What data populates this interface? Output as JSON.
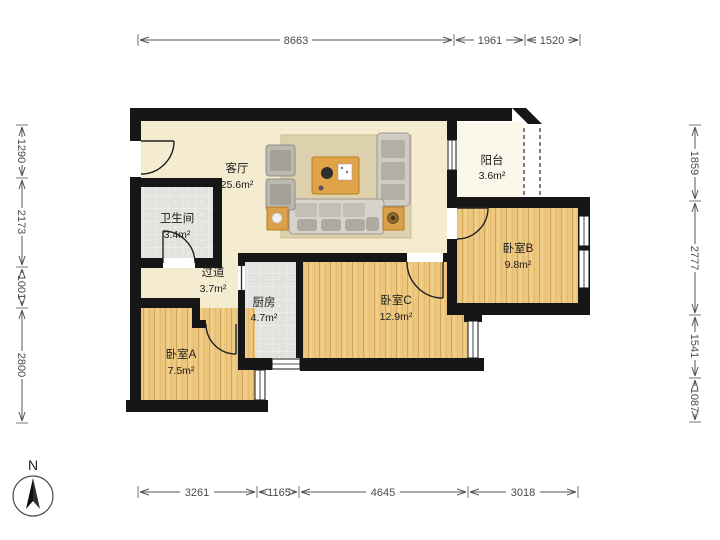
{
  "title": "apartment-floor-plan",
  "rooms": {
    "living": {
      "name": "客厅",
      "area": "25.6m²"
    },
    "balcony": {
      "name": "阳台",
      "area": "3.6m²"
    },
    "bathroom": {
      "name": "卫生间",
      "area": "3.4m²"
    },
    "hallway": {
      "name": "过道",
      "area": "3.7m²"
    },
    "kitchen": {
      "name": "厨房",
      "area": "4.7m²"
    },
    "bedroomA": {
      "name": "卧室A",
      "area": "7.5m²"
    },
    "bedroomB": {
      "name": "卧室B",
      "area": "9.8m²"
    },
    "bedroomC": {
      "name": "卧室C",
      "area": "12.9m²"
    }
  },
  "dimensions": {
    "top": [
      "8663",
      "1961",
      "1520"
    ],
    "bottom": [
      "3261",
      "1165",
      "4645",
      "3018"
    ],
    "left": [
      "1290",
      "2173",
      "1001",
      "2800"
    ],
    "right": [
      "1859",
      "2777",
      "1541",
      "1087"
    ]
  },
  "compass": {
    "label": "N"
  },
  "colors": {
    "wall": "#161616",
    "wood_floor": "#edc77e",
    "tile_floor": "#e3e2de",
    "cream_floor": "#f5ecd1",
    "balcony_floor": "#fbf7ea",
    "table_accent": "#e0a348",
    "dimension_text": "#4a4a4a"
  }
}
